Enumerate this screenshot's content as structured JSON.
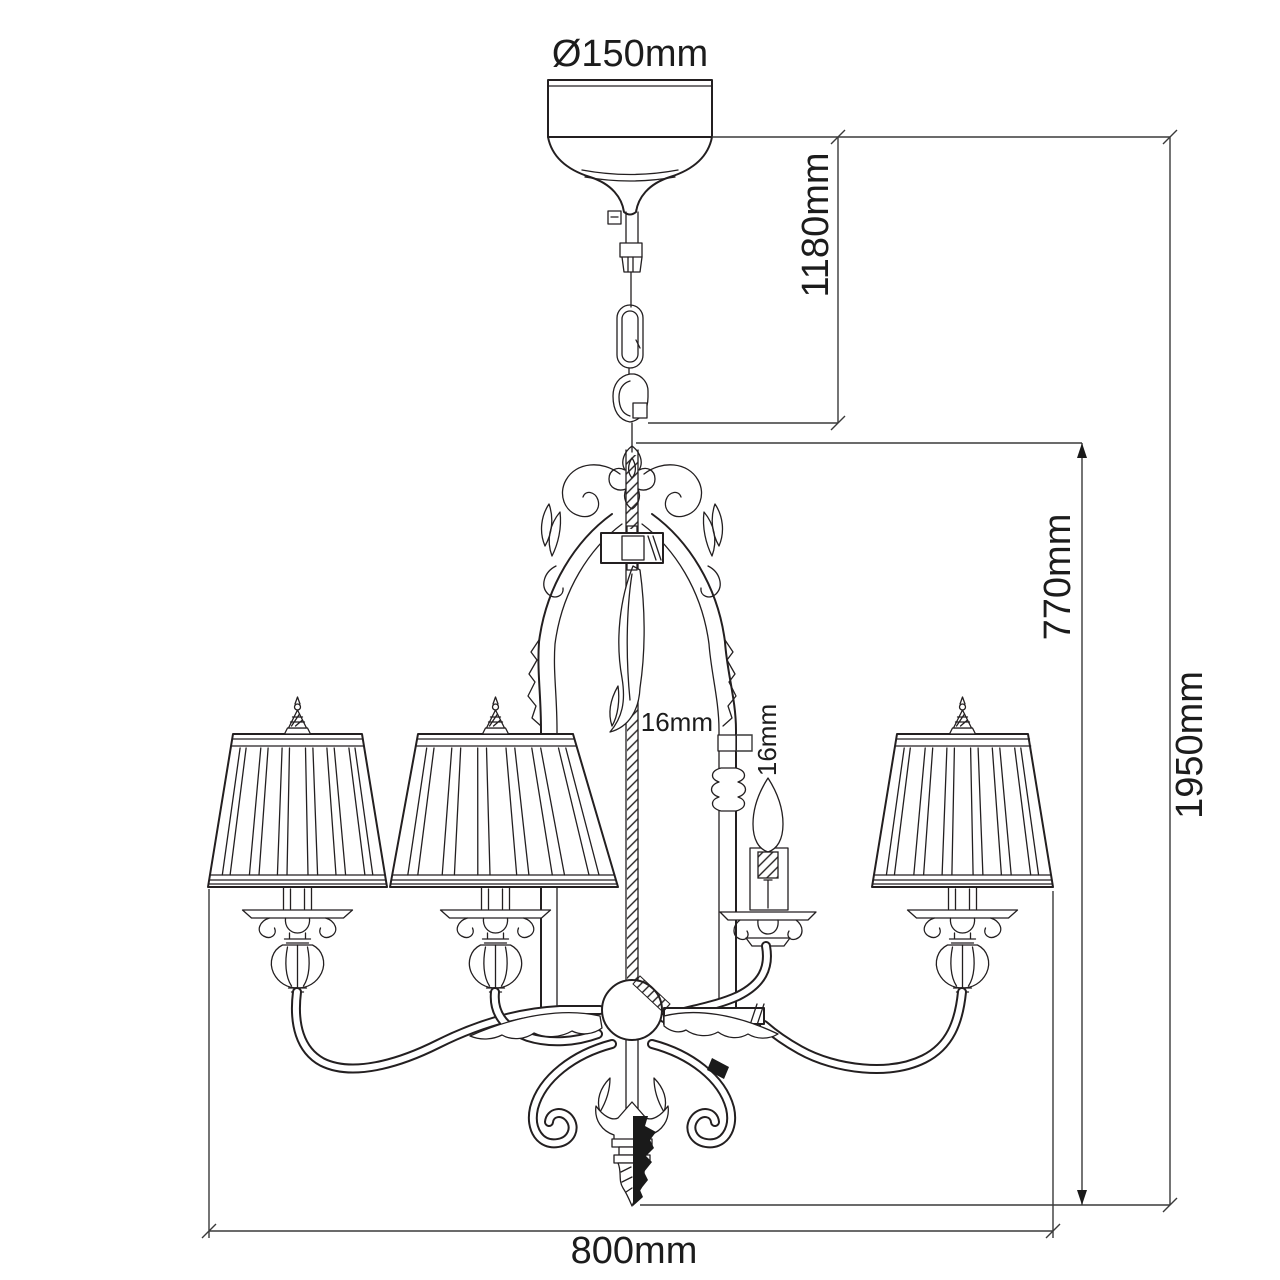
{
  "diagram": {
    "subject": "chandelier-technical-dimension-drawing",
    "style": "black line drawing on white",
    "colors": {
      "background": "#ffffff",
      "line": "#231f20",
      "dimension_line": "#3a3a3a",
      "text": "#1c1c1c"
    },
    "labels": {
      "canopy_diameter": "Ø150mm",
      "chain_drop": "1180mm",
      "body_height": "770mm",
      "total_height": "1950mm",
      "width": "800mm",
      "stem_diameter": "16mm",
      "candle_diameter": "16mm"
    },
    "parts": {
      "canopy": "ceiling canopy",
      "chain": "suspension chain with quick link",
      "body": "five-arm chandelier, three pleated shades shown, one bare candle bulb",
      "finial": "bottom spike finial"
    }
  }
}
